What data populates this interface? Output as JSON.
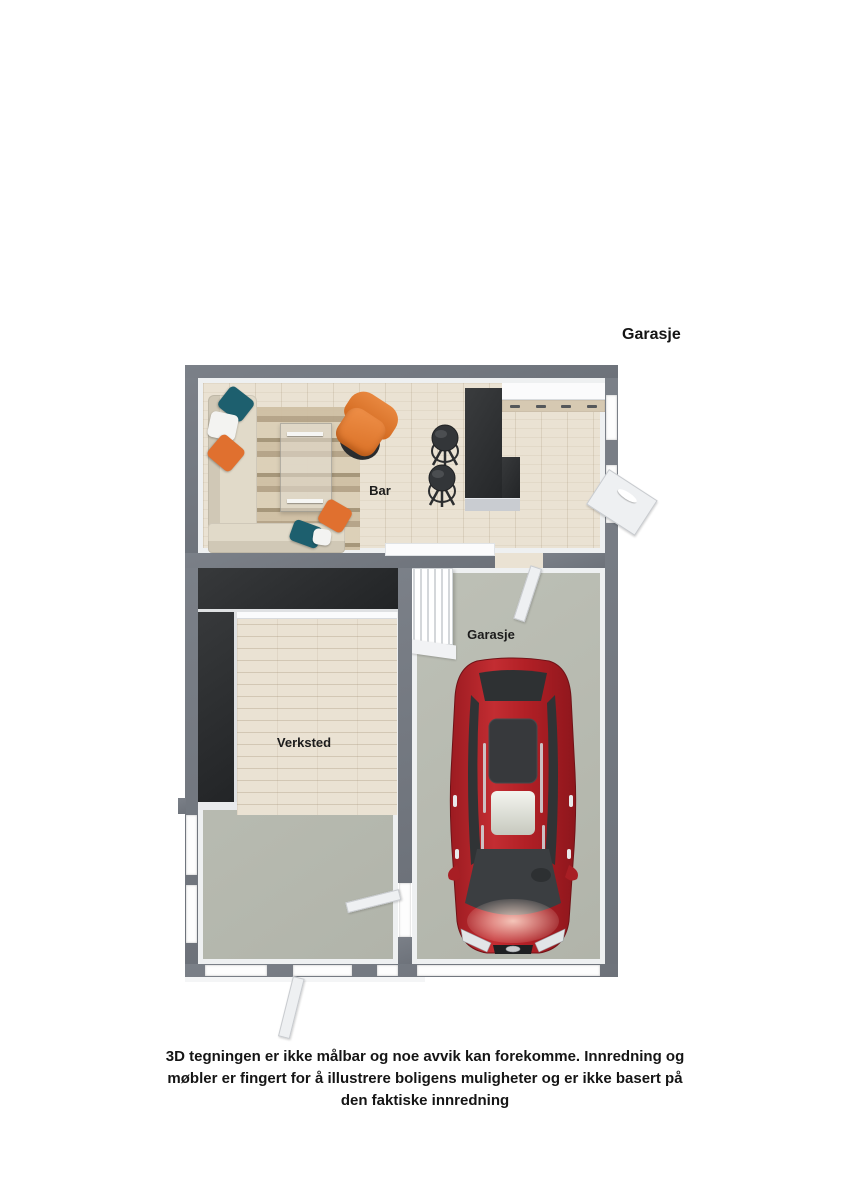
{
  "page": {
    "title": "Garasje",
    "disclaimer": "3D tegningen er ikke målbar og noe avvik kan forekomme. Innredning og møbler er fingert for å illustrere boligens muligheter og er ikke basert på den faktiske innredning"
  },
  "floorplan": {
    "type": "3d-top-view-floor-plan",
    "rooms": [
      {
        "name": "Bar",
        "floor": "light wood planks"
      },
      {
        "name": "Verksted",
        "floor": "wood planks with concrete strip"
      },
      {
        "name": "Garasje",
        "floor": "concrete"
      }
    ],
    "objects": [
      "corner-sofa-with-pillows",
      "striped-rug",
      "glass-coffee-table",
      "orange-armchair",
      "two-bar-stools",
      "black-l-shaped-bar-counter",
      "kitchen-counter-with-drawers",
      "white-sideboard",
      "black-l-shaped-workbench",
      "staircase",
      "red-car",
      "interior-doors",
      "exterior-door",
      "garage-door",
      "windows"
    ],
    "colors": {
      "wall": "#6d727a",
      "wall_hi": "#7b8088",
      "inner_face": "#eef0f1",
      "wood": "#eae2d3",
      "concrete": "#b9bcb2",
      "counter_base": "#c9ccd1",
      "sofa": "#ded7c6",
      "pillow_teal": "#1d5f6e",
      "pillow_orange": "#e0702f",
      "pillow_white": "#f3f3f1",
      "armchair": "#e0772e",
      "stool": "#333639",
      "car_body": "#b22026",
      "car_glass": "#35383b",
      "stairs": "#f4f5f6"
    }
  }
}
